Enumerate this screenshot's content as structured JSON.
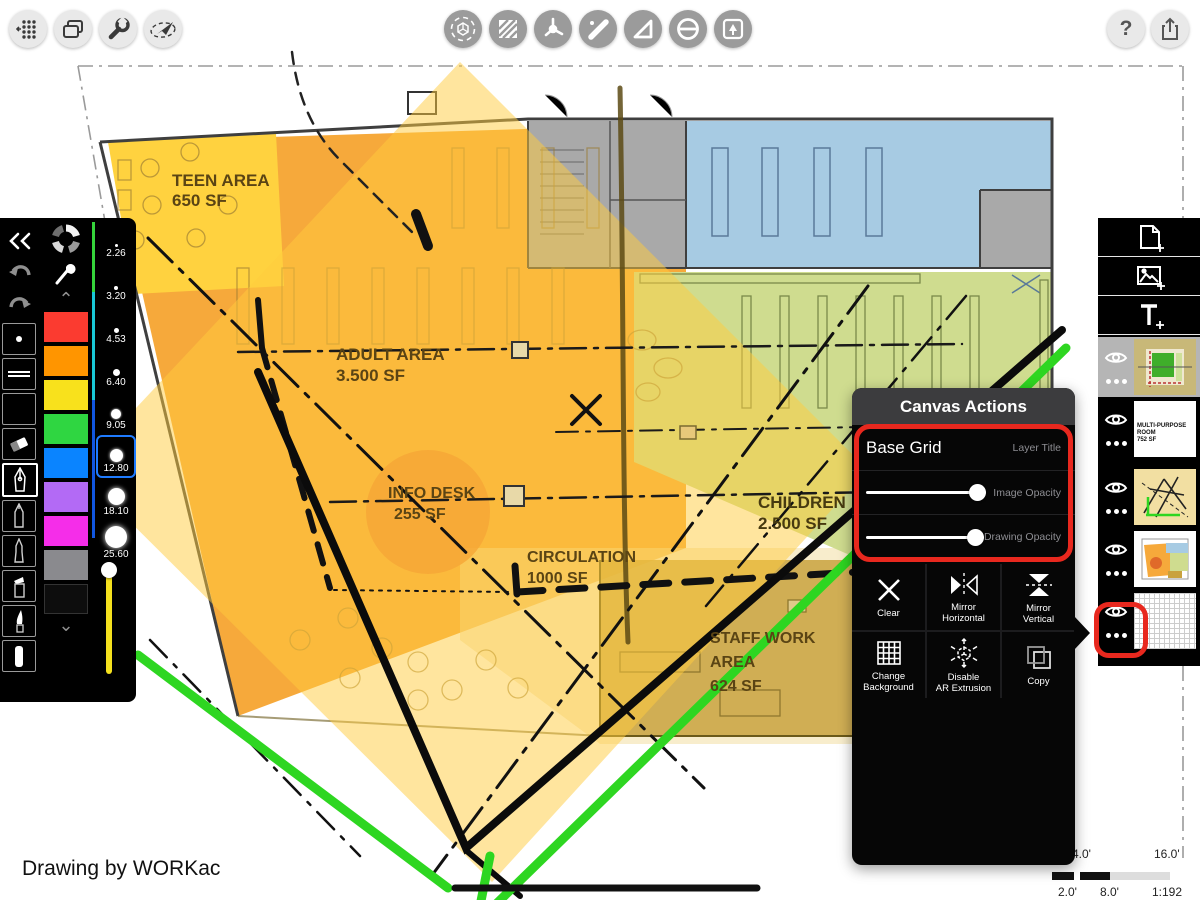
{
  "toolbar": {
    "left_icons": [
      "snap-grid",
      "pages",
      "wrench",
      "fly-through"
    ],
    "center_icons": [
      "ar-move",
      "hatch-fill",
      "protractor",
      "ruler",
      "set-square",
      "smudge-mask",
      "stamp"
    ],
    "help_label": "?",
    "right_icons": [
      "help",
      "share"
    ]
  },
  "left_panel": {
    "stroke_sizes": [
      "2.26",
      "3.20",
      "4.53",
      "6.40",
      "9.05",
      "12.80",
      "18.10",
      "25.60"
    ],
    "selected_size": "12.80",
    "swatches": [
      "#FB3B30",
      "#FF9500",
      "#F8E11C",
      "#2FD641",
      "#0A84FF",
      "#B36AF5",
      "#F52DE9",
      "#8A8A8E",
      "#0D0D0D"
    ],
    "size_strip_colors": [
      "#35D43B",
      "#19C8D6",
      "#1156E0"
    ],
    "slider_color": "#F5E11E"
  },
  "canvas_actions": {
    "title": "Canvas Actions",
    "layer_title_value": "Base Grid",
    "layer_title_label": "Layer Title",
    "image_opacity_label": "Image Opacity",
    "drawing_opacity_label": "Drawing Opacity",
    "image_opacity_percent": 85,
    "drawing_opacity_percent": 85,
    "buttons": [
      {
        "line1": "Clear",
        "line2": ""
      },
      {
        "line1": "Mirror",
        "line2": "Horizontal"
      },
      {
        "line1": "Mirror",
        "line2": "Vertical"
      },
      {
        "line1": "Change",
        "line2": "Background"
      },
      {
        "line1": "Disable",
        "line2": "AR Extrusion"
      },
      {
        "line1": "Copy",
        "line2": ""
      }
    ]
  },
  "layers_panel": {
    "add_buttons": [
      "new-page",
      "add-image",
      "add-text"
    ],
    "layers": [
      {
        "name": "green-sketch-plan",
        "selected": true
      },
      {
        "name": "room-label-layer",
        "line1": "MULTI-PURPOSE ROOM",
        "line2": "752 SF"
      },
      {
        "name": "sketch-lines-layer"
      },
      {
        "name": "program-plan-layer"
      },
      {
        "name": "base-grid-layer",
        "highlighted": true
      }
    ]
  },
  "plan": {
    "credit": "Drawing by WORKac",
    "labels": [
      {
        "name": "TEEN AREA",
        "area": "650 SF"
      },
      {
        "name": "ADULT AREA",
        "area": "3.500 SF"
      },
      {
        "name": "INFO DESK",
        "area": "255 SF"
      },
      {
        "name": "CIRCULATION",
        "area": "1000 SF"
      },
      {
        "name": "CHILDREN",
        "area": "2.500 SF"
      },
      {
        "name": "STAFF WORK",
        "name2": "AREA",
        "area": "624 SF"
      }
    ]
  },
  "scale_bar": {
    "label_4": "4.0'",
    "label_16": "16.0'",
    "label_2": "2.0'",
    "label_8": "8.0'",
    "ratio": "1:192"
  }
}
